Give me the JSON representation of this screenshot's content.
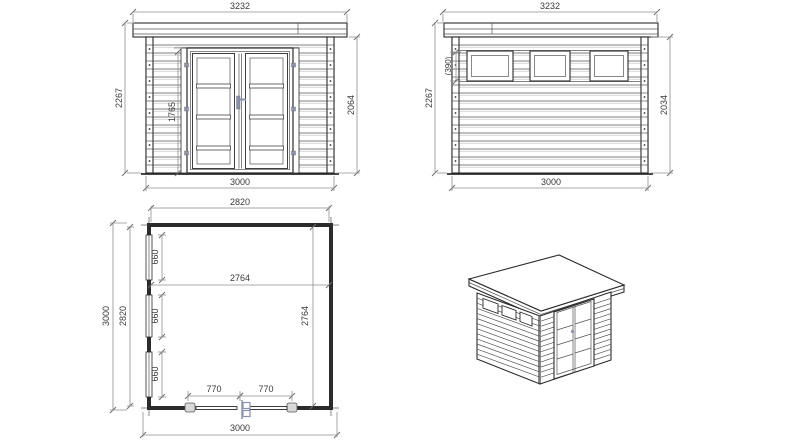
{
  "colors": {
    "background": "#ffffff",
    "drawing_line": "#2b2b2b",
    "dimension_line": "#8f8f8f",
    "dimension_text": "#3a3a3a",
    "hardware_accent": "#8892b4"
  },
  "views": {
    "front_elevation": {
      "dims": {
        "roof_width": "3232",
        "wall_height_left": "2267",
        "door_height": "1765",
        "wall_height_right": "2064",
        "wall_width": "3000"
      }
    },
    "side_elevation": {
      "dims": {
        "roof_width": "3232",
        "window_height": "(390)",
        "wall_height_left": "2267",
        "wall_height_right": "2034",
        "wall_width": "3000"
      }
    },
    "floor_plan": {
      "dims": {
        "inner_width_top": "2820",
        "outer_depth_left": "3000",
        "inner_depth_left": "2820",
        "window_segment_1": "660",
        "window_segment_2": "660",
        "window_segment_3": "660",
        "interior_width": "2764",
        "interior_depth": "2764",
        "door_leaf_left": "770",
        "door_leaf_right": "770",
        "outer_width_bottom": "3000"
      }
    }
  }
}
